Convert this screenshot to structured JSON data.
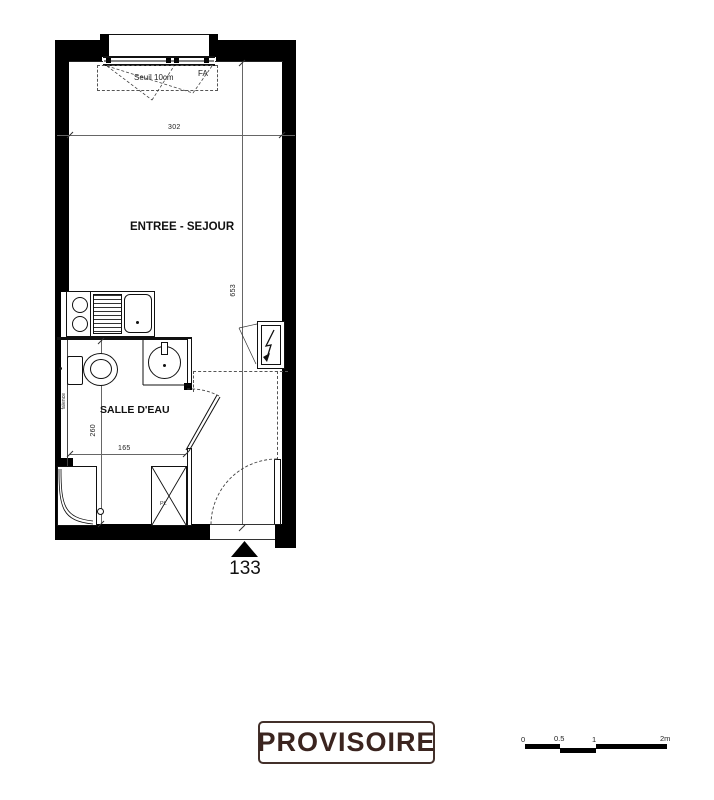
{
  "plan": {
    "window_label": "Seuil 10cm",
    "window_tag": "FA",
    "dim_width": "302",
    "dim_height": "653",
    "room_main": "ENTREE - SEJOUR",
    "room_bath": "SALLE D'EAU",
    "wall_note": "faïence",
    "dim_bath_depth": "260",
    "dim_bath_width": "165",
    "closet_label": "PL",
    "unit_number": "133"
  },
  "stamp": {
    "label": "PROVISOIRE",
    "color": "#3b241f"
  },
  "scale_bar": {
    "labels": [
      "0",
      "0.5",
      "1",
      "2m"
    ]
  },
  "colors": {
    "line": "#1a1a1a",
    "wall": "#000000"
  }
}
